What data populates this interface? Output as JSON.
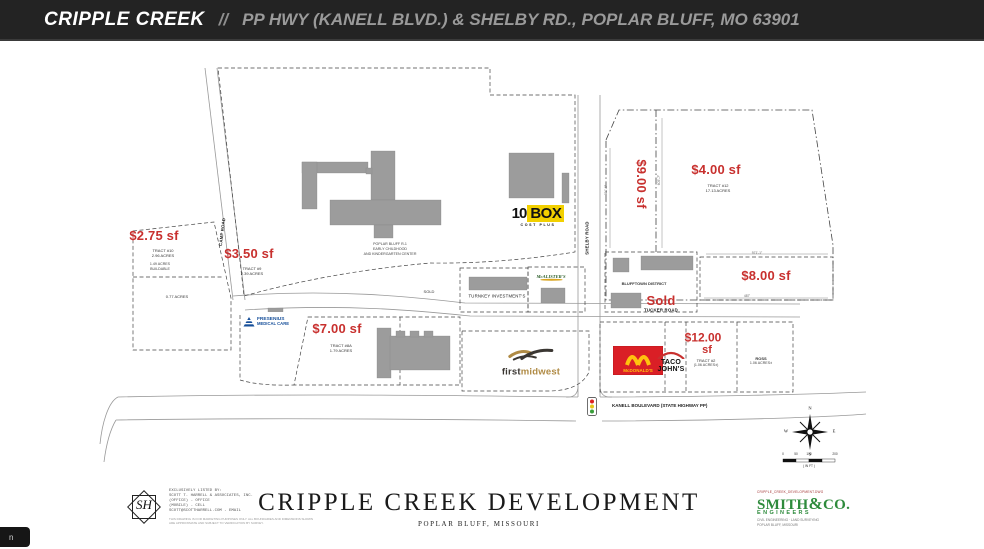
{
  "header": {
    "title": "CRIPPLE CREEK",
    "separator": "//",
    "subtitle": "PP HWY (KANELL BLVD.) & SHELBY RD., POPLAR BLUFF, MO 63901"
  },
  "corner_tab": "n",
  "colors": {
    "price_red": "#c8302e",
    "header_bg": "#232323",
    "building_gray": "#9c9c9c",
    "tenbox_yellow": "#f2d000",
    "mcdonalds_red": "#da1f26",
    "mcdonalds_yellow": "#ffc20e",
    "fresenius_blue": "#164f9a",
    "firstmidwest_gold": "#b08b45",
    "smith_green": "#2e8b3c"
  },
  "parcels": {
    "p275": {
      "price": "$2.75 sf",
      "tract": "TRACT #10",
      "acres": "2.96 ACRES",
      "note1": "1.49 ACRES",
      "note2": "BUILDABLE",
      "sub_acres": "0.77 ACRES"
    },
    "p350": {
      "price": "$3.50 sf",
      "tract": "TRACT #9",
      "acres": "2.39 ACRES"
    },
    "p400": {
      "price": "$4.00 sf",
      "tract": "TRACT #12",
      "acres": "17.13 ACRES"
    },
    "p900": {
      "price": "$9.00 sf"
    },
    "p800": {
      "price": "$8.00 sf"
    },
    "p700": {
      "price": "$7.00 sf",
      "tract": "TRACT #8A",
      "acres": "1.79 ACRES"
    },
    "p1200": {
      "price_line1": "$12.00",
      "price_line2": "sf",
      "tract": "TRACT #2",
      "acres": "(1.06 ACRES±)"
    },
    "ross": {
      "name": "ROSS",
      "acres": "1.06 ACRES±"
    },
    "blufftown": {
      "name": "BLUFFTOWN DISTRICT",
      "status": "Sold"
    },
    "turnkey": "TURNKEY INVESTMENT'S",
    "sold_small": "SOLD"
  },
  "roads": {
    "camp": "CAMP ROAD",
    "shelby": "SHELBY ROAD",
    "tucker": "TUCKER ROAD",
    "kanell": "KANELL BOULEVARD (STATE HIGHWAY PP)"
  },
  "school_label": {
    "line1": "POPLAR BLUFF R-1",
    "line2": "EARLY CHILDHOOD",
    "line3": "AND KINDERGARTEN CENTER"
  },
  "dims": {
    "d605": "605'-7\"",
    "d811": "811'-6\"",
    "d971": "971'-1\"",
    "d487": "487'"
  },
  "logos": {
    "tenbox": {
      "ten": "10",
      "box": "BOX",
      "tagline": "COST PLUS"
    },
    "mcalisters": "McALISTER'S",
    "fresenius": {
      "line1": "FRESENIUS",
      "line2": "MEDICAL CARE"
    },
    "firstmidwest": {
      "first": "first",
      "midwest": "midwest"
    },
    "mcdonalds": "McDONALD'S",
    "tacojohns": {
      "line1": "TACO",
      "line2": "JOHN'S"
    }
  },
  "compass": {
    "n": "N",
    "e": "E",
    "s": "S",
    "w": "W"
  },
  "scale": {
    "t0": "0",
    "t1": "50",
    "t2": "100",
    "t3": "200",
    "unit": "( IN FT )"
  },
  "footer": {
    "title": "CRIPPLE CREEK DEVELOPMENT",
    "subtitle": "POPLAR BLUFF, MISSOURI",
    "listing": {
      "logo": "SH",
      "line0": "EXCLUSIVELY LISTED BY:",
      "line1": "SCOTT T. HARRELL & ASSOCIATES, INC.",
      "line2": "(OFFICE)  -  OFFICE",
      "line3": "(MOBILE)  -  CELL",
      "line4": "SCOTT@SCOTTHARRELL.COM  -  EMAIL",
      "disclaimer": "THIS DRAWING IS FOR MARKETING PURPOSES ONLY. ALL BOUNDARIES AND DIMENSIONS SHOWN ARE APPROXIMATE AND SUBJECT TO VERIFICATION BY SURVEY."
    },
    "smith": {
      "file": "CRIPPLE_CREEK_DEVELOPMENT.DWG",
      "name": "SMITH",
      "amp": "&",
      "co": "CO.",
      "sub": "ENGINEERS",
      "addr1": "CIVIL ENGINEERING · LAND SURVEYING",
      "addr2": "POPLAR BLUFF, MISSOURI"
    }
  }
}
